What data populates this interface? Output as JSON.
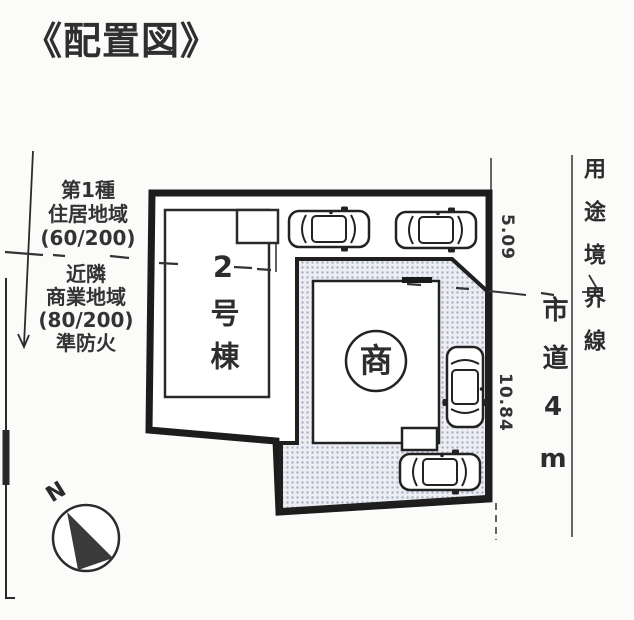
{
  "title": "《配置図》",
  "zoning": {
    "residential": {
      "type_line": "第1種",
      "district_line": "住居地域",
      "ratio_line": "(60/200)"
    },
    "commercial": {
      "area_line": "近隣",
      "district_line": "商業地域",
      "ratio_line": "(80/200)",
      "fire_line": "準防火"
    }
  },
  "site": {
    "building_label": "2号棟",
    "commercial_building_mark": "商"
  },
  "dimensions": {
    "upper_boundary_m": "5.09",
    "lower_boundary_m": "10.84"
  },
  "road": {
    "label": "市道4m"
  },
  "boundary_line": {
    "label": "用途境界線"
  },
  "compass": {
    "north": "N"
  },
  "icons": {
    "car": "car-top-view-icon",
    "compass": "north-compass-icon"
  },
  "colors": {
    "line": "#222222",
    "shade_bg": "#eceef4",
    "shade_dot": "#a8b0c2"
  }
}
